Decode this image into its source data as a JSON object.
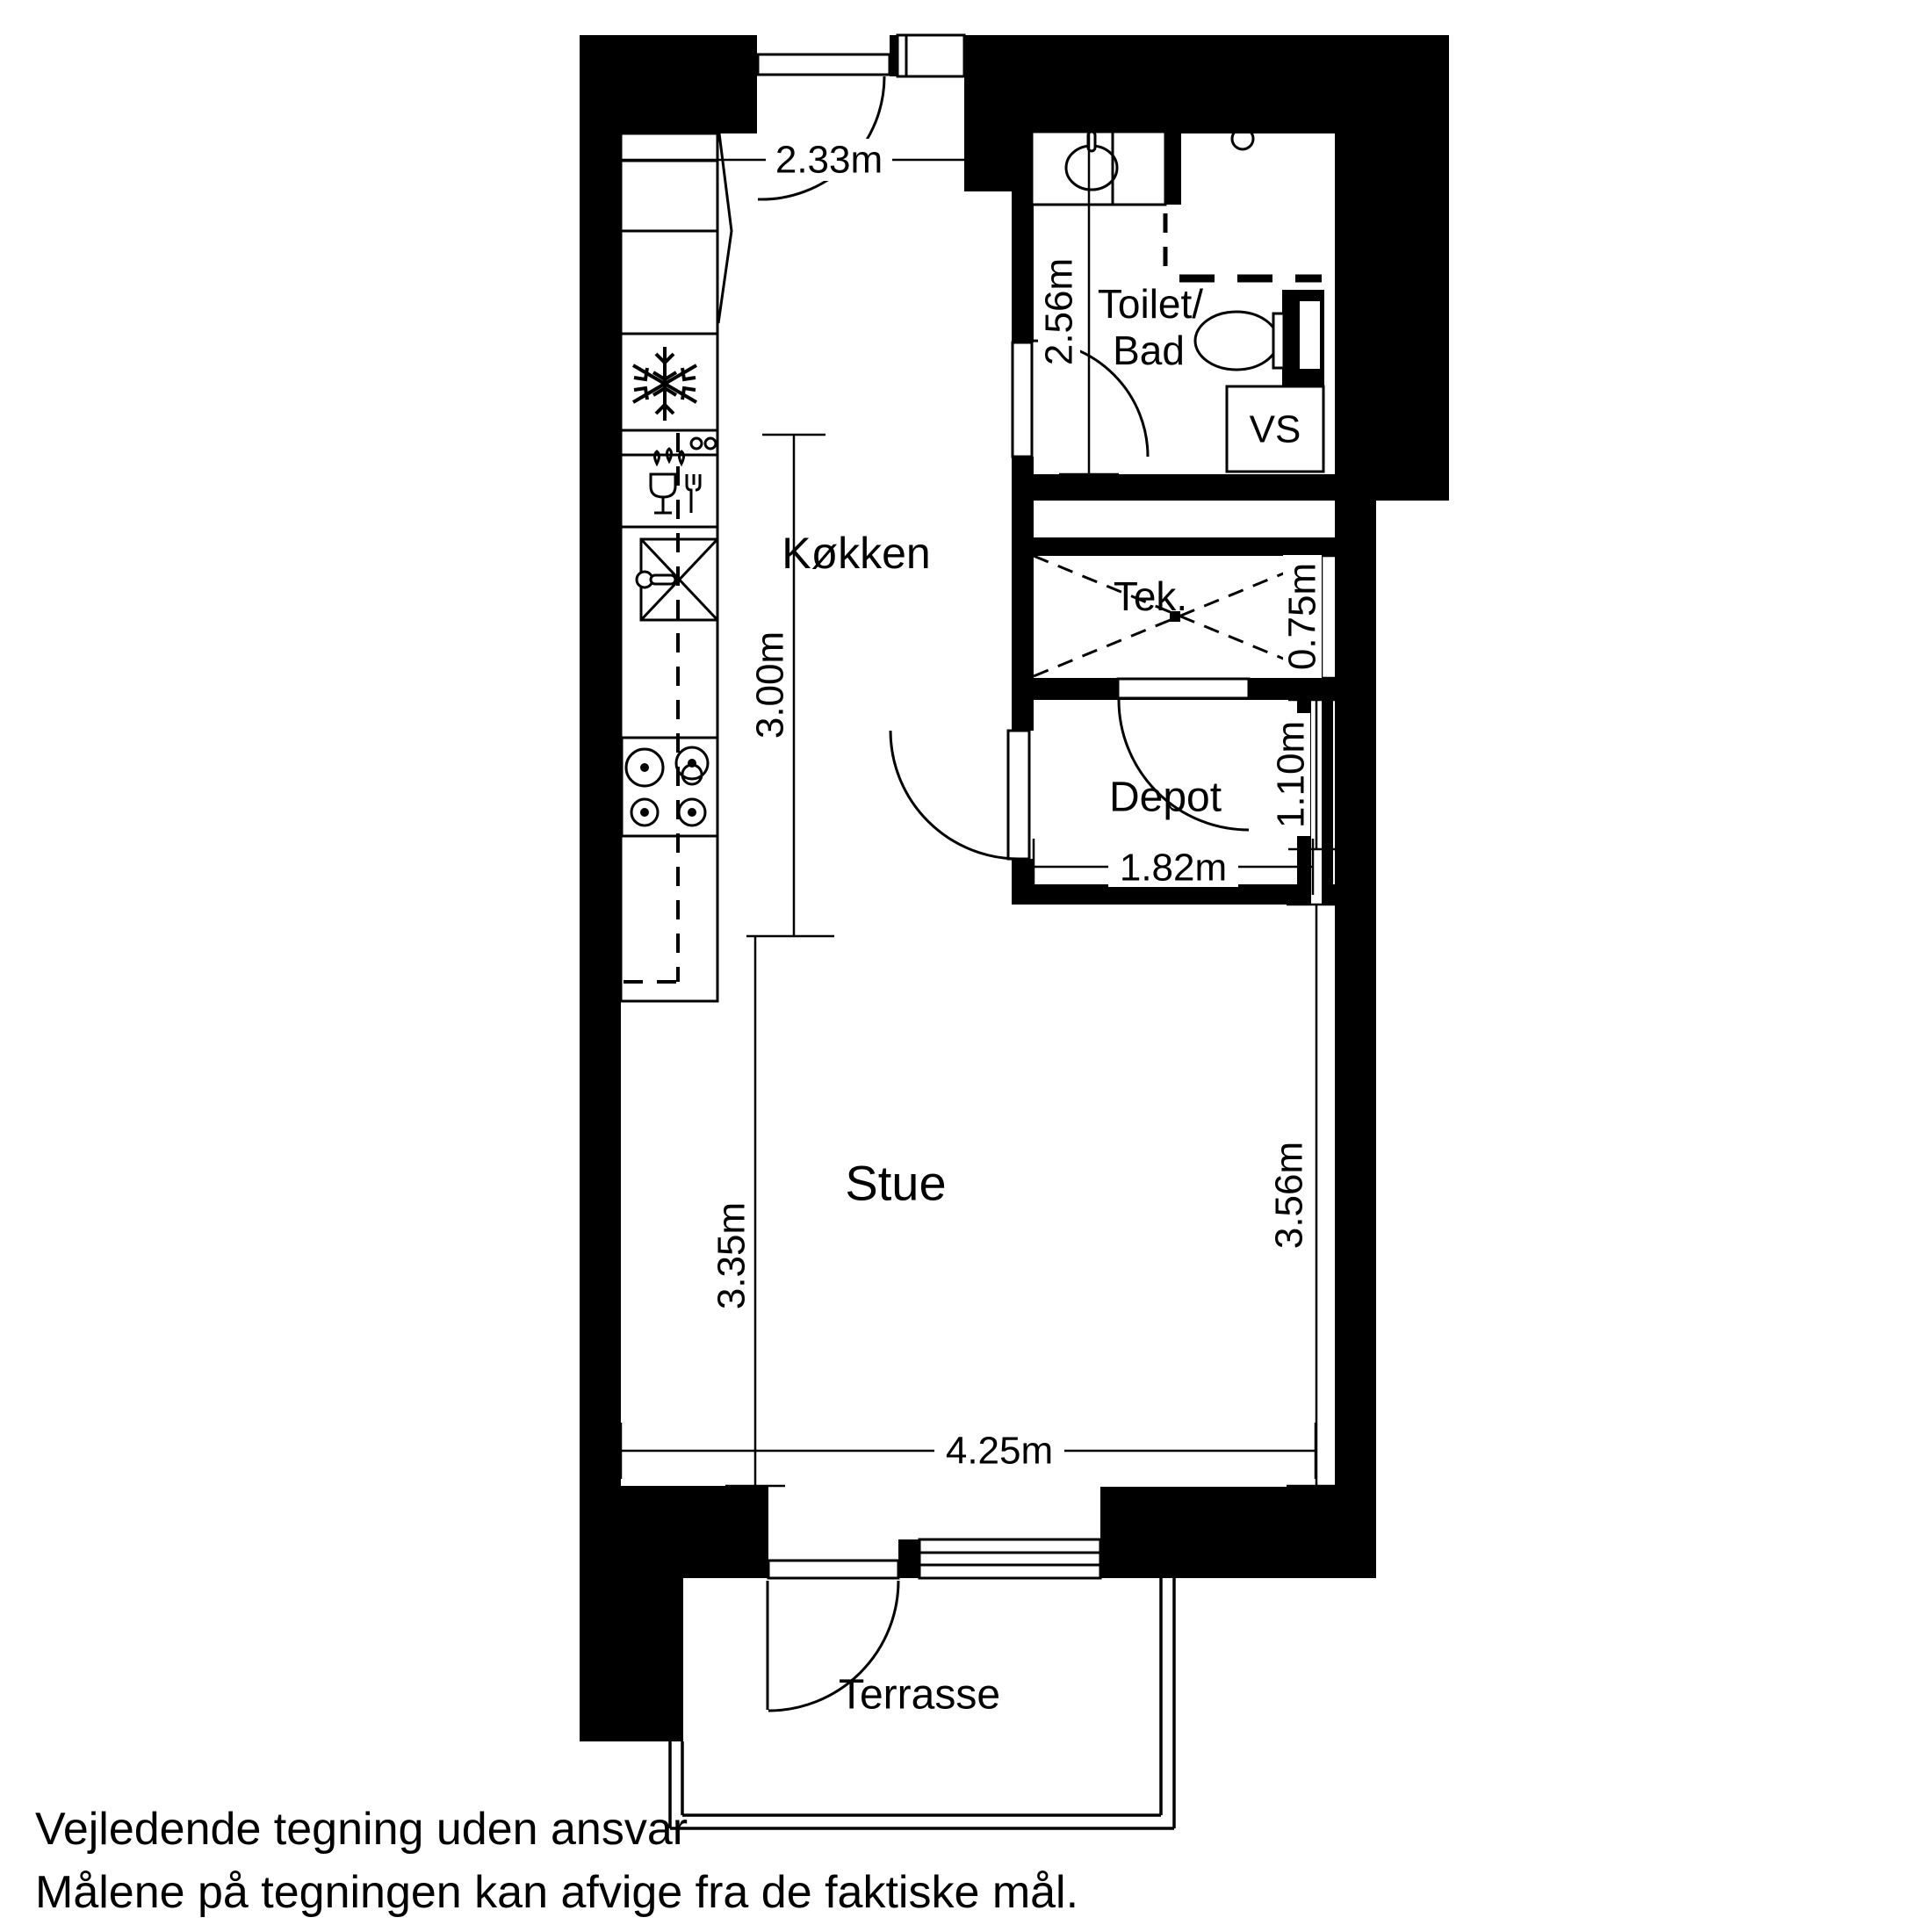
{
  "rooms": {
    "kitchen": "Køkken",
    "toilet_line1": "Toilet/",
    "toilet_line2": "Bad",
    "vs": "VS",
    "tek": "Tek.",
    "depot": "Depot",
    "living": "Stue",
    "terrace": "Terrasse"
  },
  "dimensions": {
    "hall_width": "2.33m",
    "toilet_depth": "2.56m",
    "kitchen_length": "3.00m",
    "tek_depth": "0.75m",
    "depot_depth": "1.10m",
    "depot_width": "1.82m",
    "living_left": "3.35m",
    "living_right": "3.56m",
    "living_width": "4.25m"
  },
  "footer": {
    "line1": "Vejledende tegning uden ansvar",
    "line2": "Målene på tegningen kan afvige fra de faktiske mål."
  },
  "icons": {
    "freezer": "snowflake-icon",
    "dishwasher": "glass-and-fork-icon",
    "sink": "crossed-box-with-faucet-icon",
    "stove": "four-burner-stove-icon",
    "shower": "shower-head-icon",
    "washbasin": "oval-basin-icon",
    "toilet": "toilet-bowl-icon"
  },
  "colors": {
    "walls": "#000000",
    "lines": "#000000",
    "background": "#ffffff"
  }
}
